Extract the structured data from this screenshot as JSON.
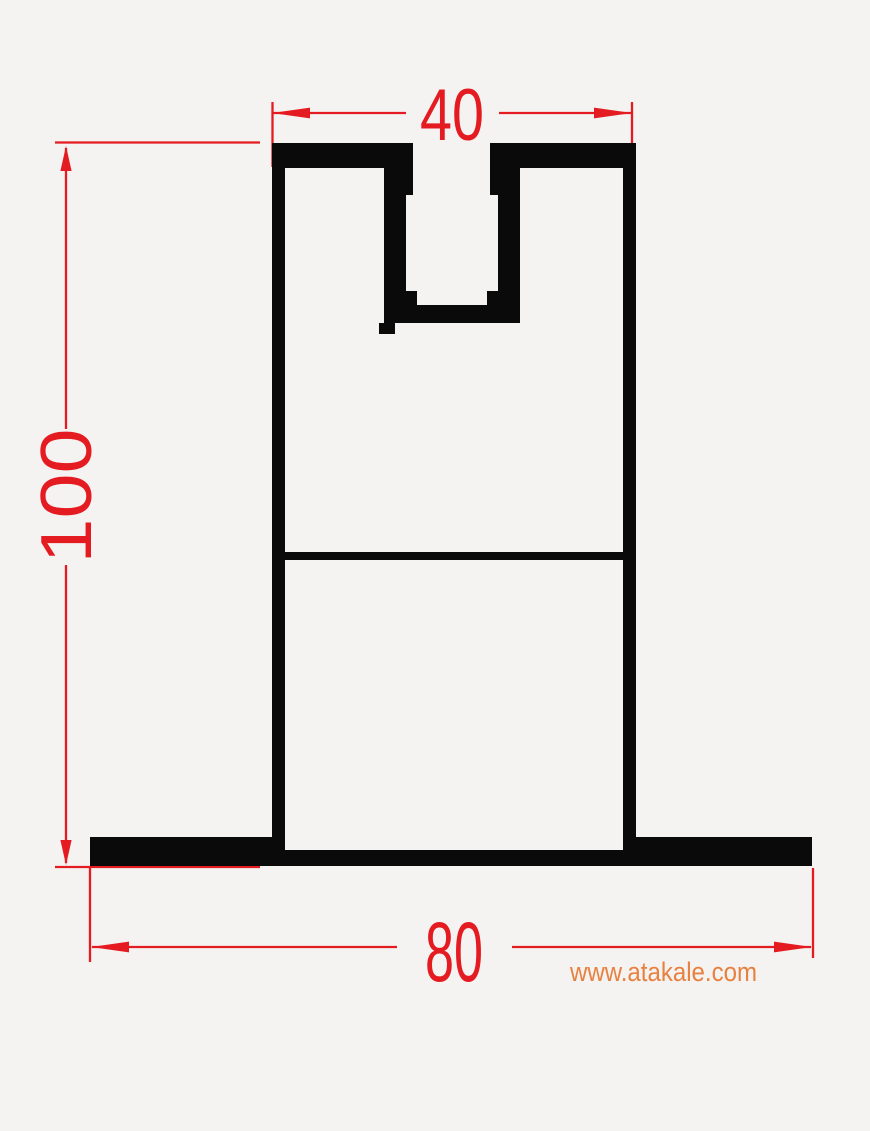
{
  "figure": {
    "type": "technical-drawing-cross-section",
    "background_color": "#f4f3f1",
    "profile_color": "#0a0a0a",
    "dimension_color": "#e41c22",
    "dimensions": {
      "top_width": {
        "value": "40",
        "orientation": "horizontal",
        "position": "top"
      },
      "height": {
        "value": "100",
        "orientation": "vertical",
        "position": "left"
      },
      "base_width": {
        "value": "80",
        "orientation": "horizontal",
        "position": "bottom"
      }
    },
    "watermark": {
      "text": "www.atakale.com",
      "color": "#e8813f"
    }
  }
}
